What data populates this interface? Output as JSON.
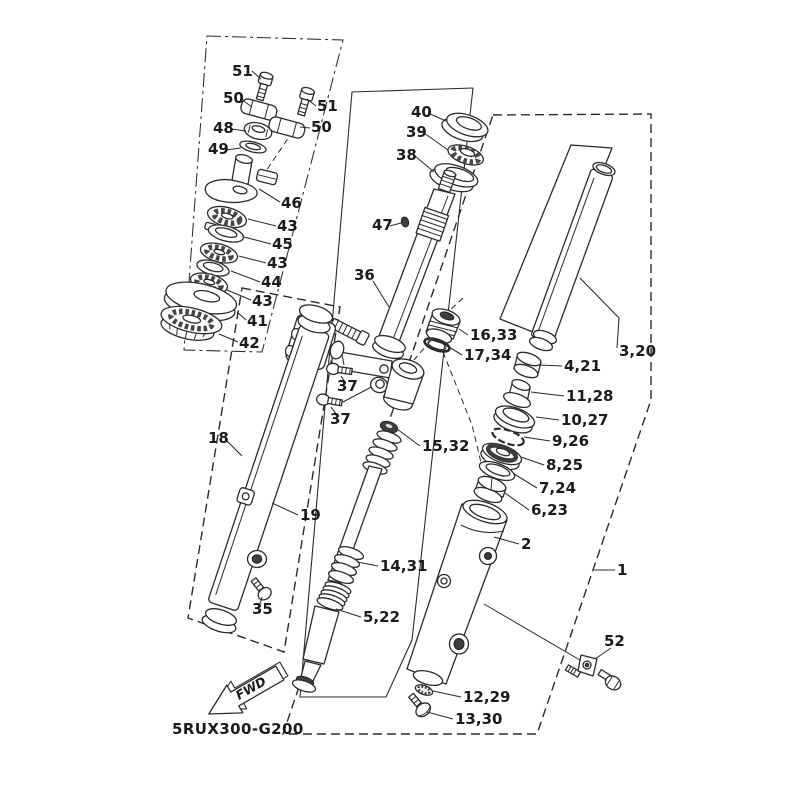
{
  "diagram": {
    "part_code": "5RUX300-G200",
    "fwd_label": "FWD",
    "line_color": "#2b2b2b",
    "background": "#ffffff",
    "callouts": [
      {
        "t": "51",
        "x": 232,
        "y": 76,
        "l": "252,71 261,79"
      },
      {
        "t": "50",
        "x": 223,
        "y": 103,
        "l": "241,99 252,107"
      },
      {
        "t": "48",
        "x": 213,
        "y": 133,
        "l": "231,129 246,131"
      },
      {
        "t": "49",
        "x": 208,
        "y": 154,
        "l": "226,150 241,148"
      },
      {
        "t": "51",
        "x": 317,
        "y": 111,
        "l": "316,106 307,99"
      },
      {
        "t": "50",
        "x": 311,
        "y": 132,
        "l": "310,128 300,127"
      },
      {
        "t": "46",
        "x": 281,
        "y": 208,
        "l": "280,202 259,189"
      },
      {
        "t": "43",
        "x": 277,
        "y": 231,
        "l": "276,226 248,219"
      },
      {
        "t": "45",
        "x": 272,
        "y": 249,
        "l": "271,244 244,237"
      },
      {
        "t": "43",
        "x": 267,
        "y": 268,
        "l": "266,263 239,256"
      },
      {
        "t": "44",
        "x": 261,
        "y": 287,
        "l": "260,282 231,271"
      },
      {
        "t": "43",
        "x": 252,
        "y": 306,
        "l": "251,300 227,290"
      },
      {
        "t": "41",
        "x": 247,
        "y": 326,
        "l": "246,320 237,312"
      },
      {
        "t": "42",
        "x": 239,
        "y": 348,
        "l": "238,342 219,334"
      },
      {
        "t": "40",
        "x": 411,
        "y": 117,
        "l": "428,113 446,121"
      },
      {
        "t": "39",
        "x": 406,
        "y": 137,
        "l": "424,133 448,150"
      },
      {
        "t": "38",
        "x": 396,
        "y": 160,
        "l": "415,156 434,172"
      },
      {
        "t": "47",
        "x": 372,
        "y": 230,
        "l": "390,226 401,223"
      },
      {
        "t": "36",
        "x": 354,
        "y": 280,
        "l": "373,281 389,307"
      },
      {
        "t": "16,33",
        "x": 470,
        "y": 340,
        "l": "468,335 459,329"
      },
      {
        "t": "17,34",
        "x": 464,
        "y": 360,
        "l": "462,355 449,347"
      },
      {
        "t": "3,20",
        "x": 619,
        "y": 356,
        "l": "580,278 619,318 617,348"
      },
      {
        "t": "4,21",
        "x": 564,
        "y": 371,
        "l": "562,366 540,365"
      },
      {
        "t": "11,28",
        "x": 566,
        "y": 401,
        "l": "564,396 531,392"
      },
      {
        "t": "10,27",
        "x": 561,
        "y": 425,
        "l": "559,420 536,417"
      },
      {
        "t": "9,26",
        "x": 552,
        "y": 446,
        "l": "550,441 524,437"
      },
      {
        "t": "8,25",
        "x": 546,
        "y": 470,
        "l": "544,465 521,457"
      },
      {
        "t": "7,24",
        "x": 539,
        "y": 493,
        "l": "537,488 514,474"
      },
      {
        "t": "6,23",
        "x": 531,
        "y": 515,
        "l": "529,510 505,493"
      },
      {
        "t": "37",
        "x": 337,
        "y": 391,
        "l": "345,382 341,376"
      },
      {
        "t": "37",
        "x": 330,
        "y": 424,
        "l": "337,415 331,407"
      },
      {
        "t": "15,32",
        "x": 422,
        "y": 451,
        "l": "420,446 397,429"
      },
      {
        "t": "18",
        "x": 208,
        "y": 443,
        "l": "225,439 242,456"
      },
      {
        "t": "19",
        "x": 300,
        "y": 520,
        "l": "298,515 272,503"
      },
      {
        "t": "2",
        "x": 521,
        "y": 549,
        "l": "519,544 494,537"
      },
      {
        "t": "1",
        "x": 617,
        "y": 575,
        "l": "615,570 594,570"
      },
      {
        "t": "14,31",
        "x": 380,
        "y": 571,
        "l": "378,566 357,562"
      },
      {
        "t": "5,22",
        "x": 363,
        "y": 622,
        "l": "361,617 336,609"
      },
      {
        "t": "35",
        "x": 252,
        "y": 614,
        "l": "260,604 262,597"
      },
      {
        "t": "52",
        "x": 604,
        "y": 646,
        "l": "611,648 595,659"
      },
      {
        "t": "12,29",
        "x": 463,
        "y": 702,
        "l": "461,697 433,691"
      },
      {
        "t": "13,30",
        "x": 455,
        "y": 724,
        "l": "453,719 427,712"
      }
    ]
  }
}
